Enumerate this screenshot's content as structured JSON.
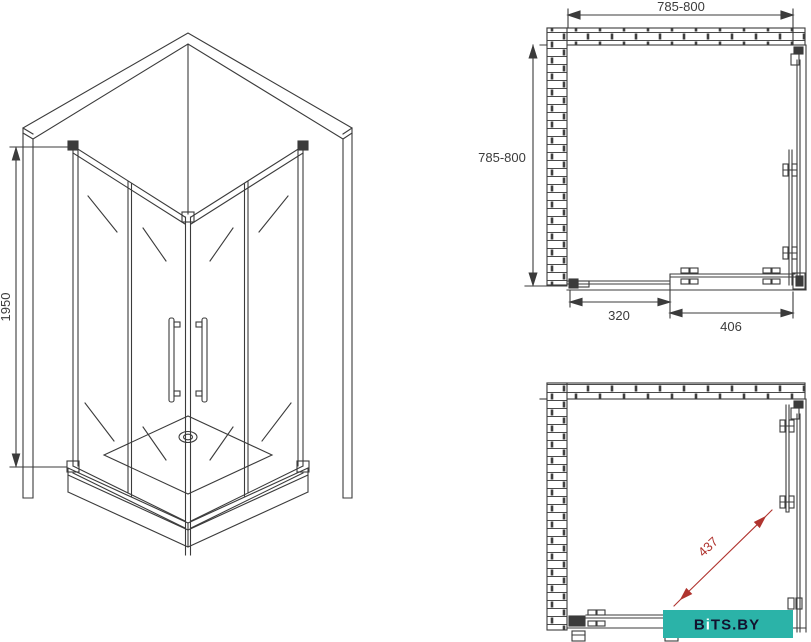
{
  "colors": {
    "line": "#3b3b3b",
    "red": "#b0342f",
    "teal": "#2bb3a8",
    "watermark_dark": "#12122e",
    "watermark_light": "#ffffff",
    "background": "#ffffff"
  },
  "iso_view": {
    "height_dim_label": "1950"
  },
  "plan_view": {
    "width_dim_label": "785-800",
    "depth_dim_label": "785-800",
    "fixed_segment_dim_label": "320",
    "door_segment_dim_label": "406"
  },
  "entry_view": {
    "entry_dim_label": "437"
  },
  "watermark": {
    "part_b": "B",
    "part_i": "i",
    "part_rest": "TS.BY"
  }
}
